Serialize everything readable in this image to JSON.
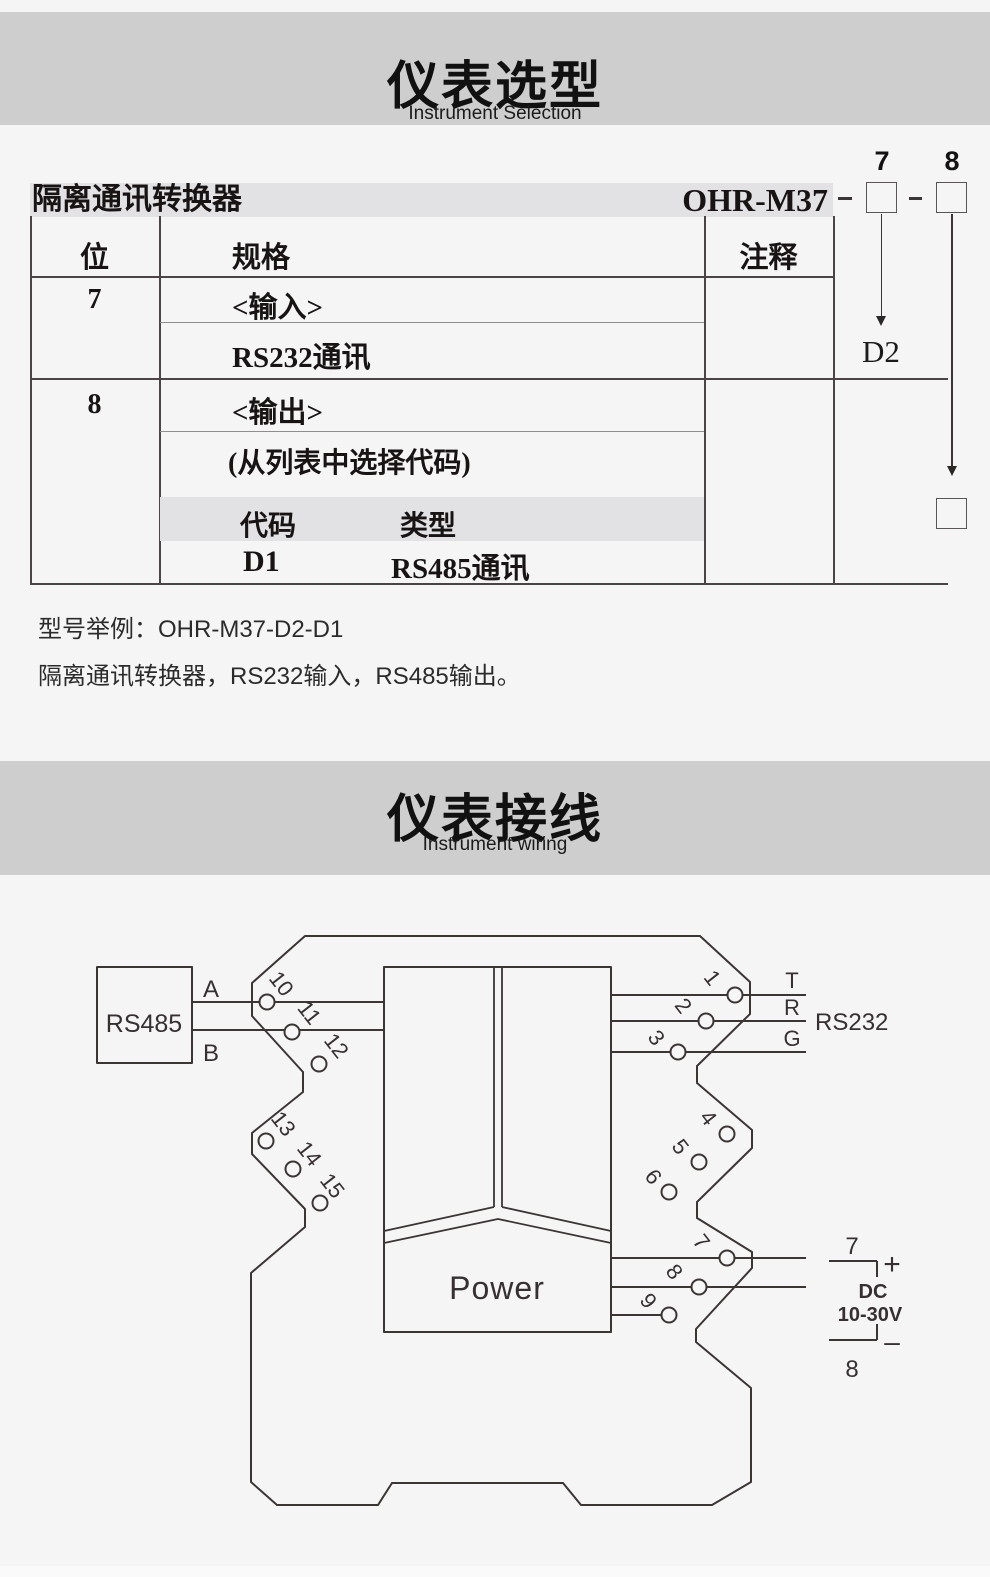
{
  "section1": {
    "title": "仪表选型",
    "subtitle": "Instrument Selection"
  },
  "selection": {
    "product_label": "隔离通讯转换器",
    "model": "OHR-M37",
    "dash": "–",
    "digit7": "7",
    "digit8": "8",
    "code7": "D2",
    "table": {
      "col_pos": "位",
      "col_spec": "规格",
      "col_note": "注释",
      "row7": {
        "pos": "7",
        "spec_header": "<输入>",
        "spec_value": "RS232通讯"
      },
      "row8": {
        "pos": "8",
        "spec_header": "<输出>",
        "spec_note": "(从列表中选择代码)",
        "code_col": "代码",
        "type_col": "类型",
        "code": "D1",
        "type": "RS485通讯"
      }
    },
    "example_line1": "型号举例：OHR-M37-D2-D1",
    "example_line2": "隔离通讯转换器，RS232输入，RS485输出。"
  },
  "section2": {
    "title": "仪表接线",
    "subtitle": "Instrument wiring"
  },
  "wiring": {
    "rs485_label": "RS485",
    "a_label": "A",
    "b_label": "B",
    "t_label": "T",
    "r_label": "R",
    "g_label": "G",
    "rs232_label": "RS232",
    "power_label": "Power",
    "supply": {
      "top_num": "7",
      "plus": "+",
      "dc": "DC",
      "range": "10-30V",
      "minus": "–",
      "bottom_num": "8"
    },
    "terminals_left": [
      "10",
      "11",
      "12",
      "13",
      "14",
      "15"
    ],
    "terminals_right": [
      "1",
      "2",
      "3",
      "4",
      "5",
      "6",
      "7",
      "8",
      "9"
    ]
  }
}
